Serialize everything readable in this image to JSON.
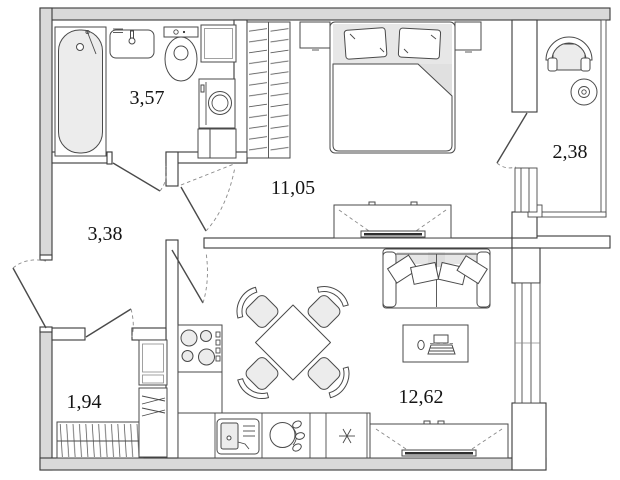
{
  "plan": {
    "type": "apartment-floor-plan",
    "rooms": {
      "bathroom": {
        "area_label": "3,57"
      },
      "hallway": {
        "area_label": "3,38"
      },
      "bedroom": {
        "area_label": "11,05"
      },
      "balcony": {
        "area_label": "2,38"
      },
      "storage": {
        "area_label": "1,94"
      },
      "living_kitchen": {
        "area_label": "12,62"
      }
    },
    "furniture_icons": [
      "bathtub",
      "washbasin",
      "toilet",
      "washing-machine",
      "bathroom-cabinet",
      "hanger-wardrobe",
      "double-bed",
      "pillow",
      "bedside-table",
      "tv-unit",
      "balcony-armchair",
      "balcony-round-table",
      "sofa",
      "coffee-table",
      "laptop",
      "dining-table",
      "dining-chair",
      "cooktop",
      "kitchen-sink",
      "dishwasher",
      "fridge-snowflake",
      "closet-rail"
    ],
    "colors": {
      "wall_fill": "#d9d9d9",
      "line": "#3a3a3a",
      "furniture_fill": "#ececec",
      "background": "#ffffff",
      "tv_screen": "#2f2f2f"
    }
  }
}
